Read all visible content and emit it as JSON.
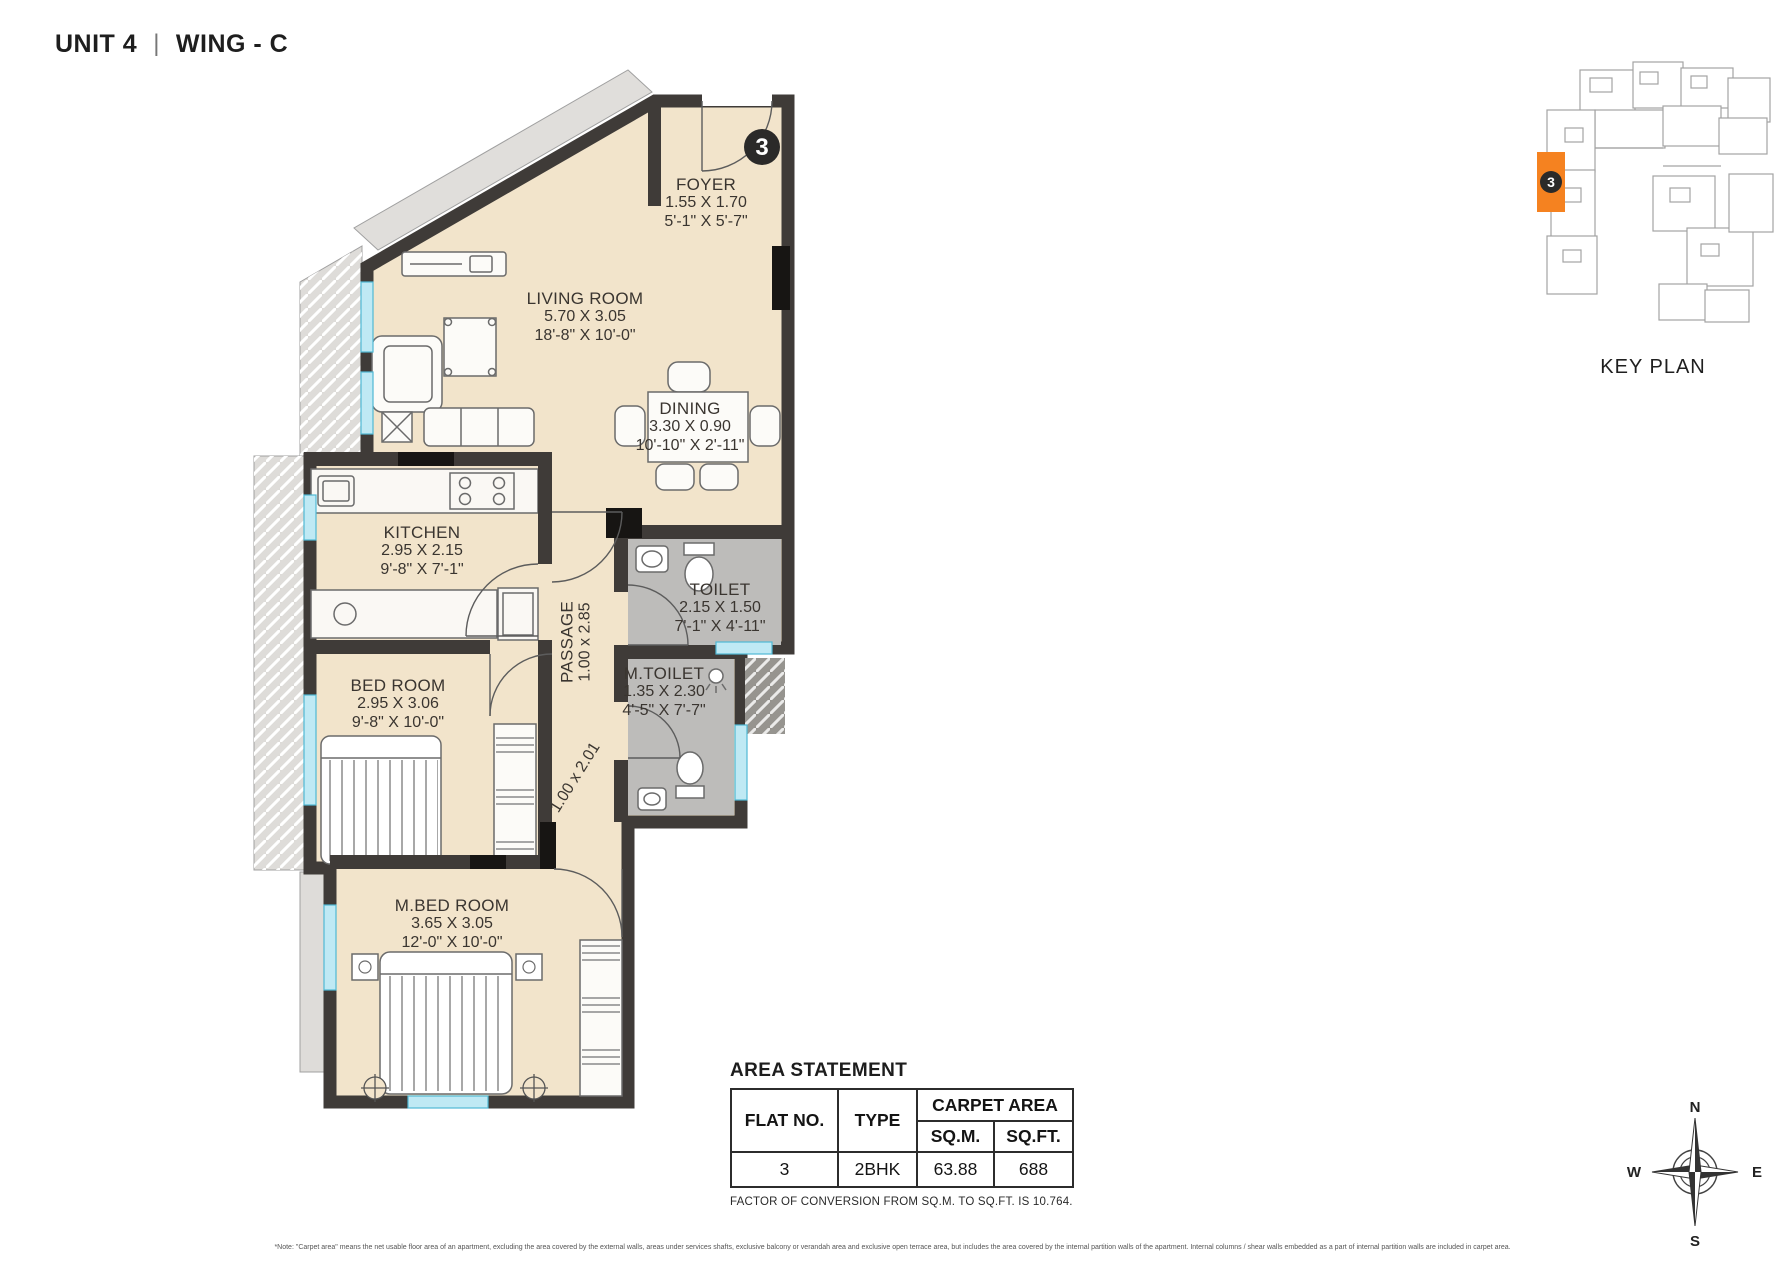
{
  "title": {
    "unit": "UNIT 4",
    "separator": "|",
    "wing": "WING - C"
  },
  "unit_badge": "3",
  "rooms": {
    "foyer": {
      "name": "FOYER",
      "dim_m": "1.55 X 1.70",
      "dim_ft": "5'-1\" X 5'-7\""
    },
    "living": {
      "name": "LIVING ROOM",
      "dim_m": "5.70 X 3.05",
      "dim_ft": "18'-8\" X 10'-0\""
    },
    "dining": {
      "name": "DINING",
      "dim_m": "3.30 X 0.90",
      "dim_ft": "10'-10\" X 2'-11\""
    },
    "kitchen": {
      "name": "KITCHEN",
      "dim_m": "2.95 X 2.15",
      "dim_ft": "9'-8\" X 7'-1\""
    },
    "toilet": {
      "name": "TOILET",
      "dim_m": "2.15 X 1.50",
      "dim_ft": "7'-1\" X 4'-11\""
    },
    "mtoilet": {
      "name": "M.TOILET",
      "dim_m": "1.35 X 2.30",
      "dim_ft": "4'-5\" X 7'-7\""
    },
    "passage": {
      "name": "PASSAGE",
      "dim_m": "1.00 x 2.85"
    },
    "passage2": {
      "dim_m": "1.00 x 2.01"
    },
    "bedroom": {
      "name": "BED ROOM",
      "dim_m": "2.95 X 3.06",
      "dim_ft": "9'-8\" X 10'-0\""
    },
    "mbedroom": {
      "name": "M.BED ROOM",
      "dim_m": "3.65 X 3.05",
      "dim_ft": "12'-0\" X 10'-0\""
    }
  },
  "key_plan": {
    "label": "KEY PLAN",
    "badge": "3",
    "highlight_color": "#F58220"
  },
  "area_statement": {
    "title": "AREA STATEMENT",
    "headers": {
      "flat_no": "FLAT NO.",
      "type": "TYPE",
      "carpet_area": "CARPET AREA",
      "sqm": "SQ.M.",
      "sqft": "SQ.FT."
    },
    "rows": [
      {
        "flat_no": "3",
        "type": "2BHK",
        "sqm": "63.88",
        "sqft": "688"
      }
    ],
    "conversion_note": "FACTOR OF CONVERSION FROM SQ.M. TO SQ.FT. IS 10.764."
  },
  "compass": {
    "n": "N",
    "e": "E",
    "s": "S",
    "w": "W"
  },
  "footnote": "*Note: \"Carpet area\" means the net usable floor area of an apartment, excluding the area covered by the external walls, areas under services shafts, exclusive balcony or verandah area and exclusive open terrace area, but includes the area covered by the internal partition walls of the apartment. Internal columns / shear walls embedded as a part of internal partition walls are included in carpet area.",
  "colors": {
    "wall": "#3f3b38",
    "floor": "#f2e4cb",
    "toilet_floor": "#bdbcba",
    "window": "#bfe9f4",
    "highlight": "#F58220"
  }
}
